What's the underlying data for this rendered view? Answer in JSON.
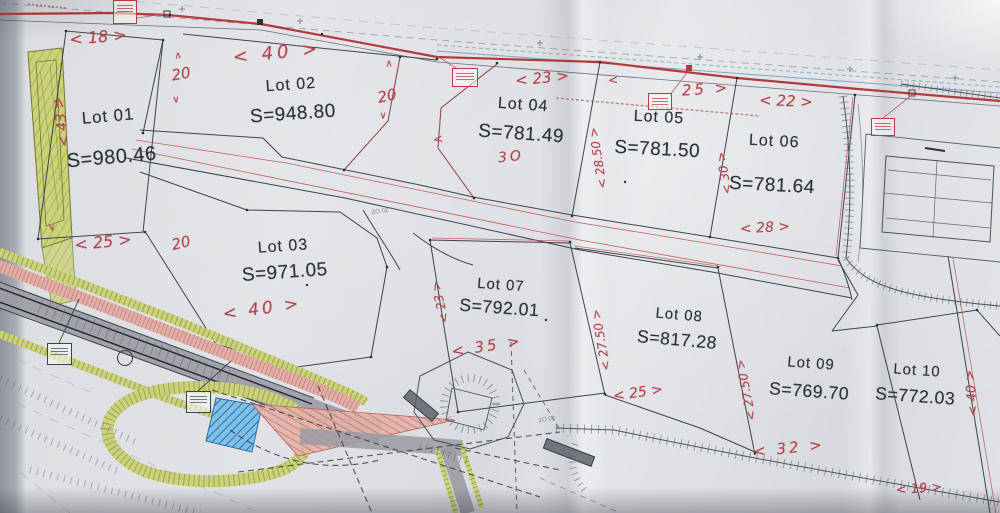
{
  "document": {
    "kind": "photographed cadastral subdivision plan",
    "lots_total": 10
  },
  "palette": {
    "paper": "#e0e1e4",
    "printed_ink": "#2b3139",
    "handwriting_red": "#b2444e",
    "road_red_line": "#b23a3a",
    "boundary_dark": "#3c444e",
    "verge_olive": "#c9d265",
    "strip_salmon": "#dba39b",
    "water_blue": "#5aa7d4",
    "road_gray": "#9b9ba3"
  },
  "lots": [
    {
      "name": "Lot 01",
      "area": "S=980.46",
      "x": 110,
      "y": 138,
      "rot": -5,
      "scale": 1.05,
      "gap": 20
    },
    {
      "name": "Lot 02",
      "area": "S=948.80",
      "x": 292,
      "y": 101,
      "rot": -4,
      "scale": 1.0,
      "gap": 9
    },
    {
      "name": "Lot 03",
      "area": "S=971.05",
      "x": 284,
      "y": 261,
      "rot": -4,
      "scale": 1.0,
      "gap": 6
    },
    {
      "name": "Lot 04",
      "area": "S=781.49",
      "x": 522,
      "y": 121,
      "rot": 4,
      "scale": 1.0,
      "gap": 9
    },
    {
      "name": "Lot 05",
      "area": "S=781.50",
      "x": 658,
      "y": 135,
      "rot": 3,
      "scale": 1.0,
      "gap": 12
    },
    {
      "name": "Lot 06",
      "area": "S=781.64",
      "x": 773,
      "y": 165,
      "rot": 3,
      "scale": 1.0,
      "gap": 24
    },
    {
      "name": "Lot 07",
      "area": "S=792.01",
      "x": 500,
      "y": 298,
      "rot": 4,
      "scale": 0.93,
      "gap": 4
    },
    {
      "name": "Lot 08",
      "area": "S=817.28",
      "x": 678,
      "y": 329,
      "rot": 5,
      "scale": 0.93,
      "gap": 6
    },
    {
      "name": "Lot 09",
      "area": "S=769.70",
      "x": 810,
      "y": 379,
      "rot": 4,
      "scale": 0.93,
      "gap": 9
    },
    {
      "name": "Lot 10",
      "area": "S=772.03",
      "x": 916,
      "y": 385,
      "rot": 4,
      "scale": 0.93,
      "gap": 7
    }
  ],
  "dimensions": [
    {
      "t": "< 18 >",
      "x": 98,
      "y": 37,
      "r": -5,
      "s": 16
    },
    {
      "t": "< 43 >",
      "x": 62,
      "y": 122,
      "r": -97,
      "s": 14
    },
    {
      "t": "< 25 >",
      "x": 103,
      "y": 242,
      "r": -6,
      "s": 16
    },
    {
      "t": "20",
      "x": 181,
      "y": 74,
      "r": -10,
      "s": 15
    },
    {
      "t": "∧",
      "x": 178,
      "y": 56,
      "r": -5,
      "s": 10
    },
    {
      "t": "∨",
      "x": 176,
      "y": 100,
      "r": -5,
      "s": 10
    },
    {
      "t": "< 40 >",
      "x": 277,
      "y": 53,
      "r": -6,
      "s": 18,
      "sp": 4
    },
    {
      "t": "20",
      "x": 387,
      "y": 96,
      "r": -12,
      "s": 15
    },
    {
      "t": "∧",
      "x": 389,
      "y": 64,
      "r": 0,
      "s": 10
    },
    {
      "t": "∨",
      "x": 383,
      "y": 116,
      "r": 0,
      "s": 10
    },
    {
      "t": "20",
      "x": 181,
      "y": 243,
      "r": -14,
      "s": 15
    },
    {
      "t": "< 40 >",
      "x": 262,
      "y": 309,
      "r": -8,
      "s": 17,
      "sp": 3
    },
    {
      "t": "< 23 >",
      "x": 542,
      "y": 78,
      "r": -6,
      "s": 15
    },
    {
      "t": "<",
      "x": 438,
      "y": 139,
      "r": -10,
      "s": 12
    },
    {
      "t": "3O",
      "x": 511,
      "y": 157,
      "r": -6,
      "s": 14,
      "sp": 3
    },
    {
      "t": "< 28.50 >",
      "x": 598,
      "y": 158,
      "r": -99,
      "s": 12
    },
    {
      "t": "<",
      "x": 613,
      "y": 80,
      "r": -5,
      "s": 12
    },
    {
      "t": "25 >",
      "x": 706,
      "y": 89,
      "r": -4,
      "s": 15,
      "sp": 3
    },
    {
      "t": "< 22 >",
      "x": 786,
      "y": 101,
      "r": 2,
      "s": 15
    },
    {
      "t": "< 30 >",
      "x": 724,
      "y": 173,
      "r": -99,
      "s": 12
    },
    {
      "t": "< 28 >",
      "x": 765,
      "y": 228,
      "r": -3,
      "s": 14
    },
    {
      "t": "< 23 >",
      "x": 440,
      "y": 302,
      "r": -103,
      "s": 12
    },
    {
      "t": "< 35 >",
      "x": 487,
      "y": 346,
      "r": -9,
      "s": 15,
      "sp": 3
    },
    {
      "t": "< 27.50 >",
      "x": 601,
      "y": 340,
      "r": -100,
      "s": 12
    },
    {
      "t": "< 27.50 >",
      "x": 746,
      "y": 390,
      "r": -101,
      "s": 12
    },
    {
      "t": "< 25 >",
      "x": 638,
      "y": 393,
      "r": -8,
      "s": 14
    },
    {
      "t": "< 32 >",
      "x": 789,
      "y": 448,
      "r": -6,
      "s": 15,
      "sp": 3
    },
    {
      "t": "< 19 >",
      "x": 919,
      "y": 489,
      "r": -4,
      "s": 13
    },
    {
      "t": "< 40 >",
      "x": 972,
      "y": 393,
      "r": -95,
      "s": 13
    },
    {
      "t": "∨",
      "x": 52,
      "y": 228,
      "r": -10,
      "s": 10
    },
    {
      "t": "∨",
      "x": 57,
      "y": 103,
      "r": -10,
      "s": 10
    }
  ],
  "stamps": [
    {
      "x": 113,
      "y": 0,
      "w": 24,
      "h": 24
    },
    {
      "x": 452,
      "y": 68,
      "w": 26,
      "h": 19
    },
    {
      "x": 648,
      "y": 93,
      "w": 24,
      "h": 17
    },
    {
      "x": 871,
      "y": 118,
      "w": 24,
      "h": 18
    }
  ],
  "note_boxes": [
    {
      "x": 47,
      "y": 343,
      "w": 25,
      "h": 22
    },
    {
      "x": 186,
      "y": 391,
      "w": 25,
      "h": 22
    }
  ],
  "rotated_tags": [
    {
      "x": 402,
      "y": 400,
      "w": 36,
      "h": 9,
      "rot": 40
    },
    {
      "x": 543,
      "y": 447,
      "w": 50,
      "h": 9,
      "rot": 21
    }
  ],
  "tiny_labels": [
    {
      "t": "ZO 02",
      "x": 380,
      "y": 212,
      "r": -8
    },
    {
      "t": "ZO 02",
      "x": 547,
      "y": 420,
      "r": -10
    }
  ]
}
